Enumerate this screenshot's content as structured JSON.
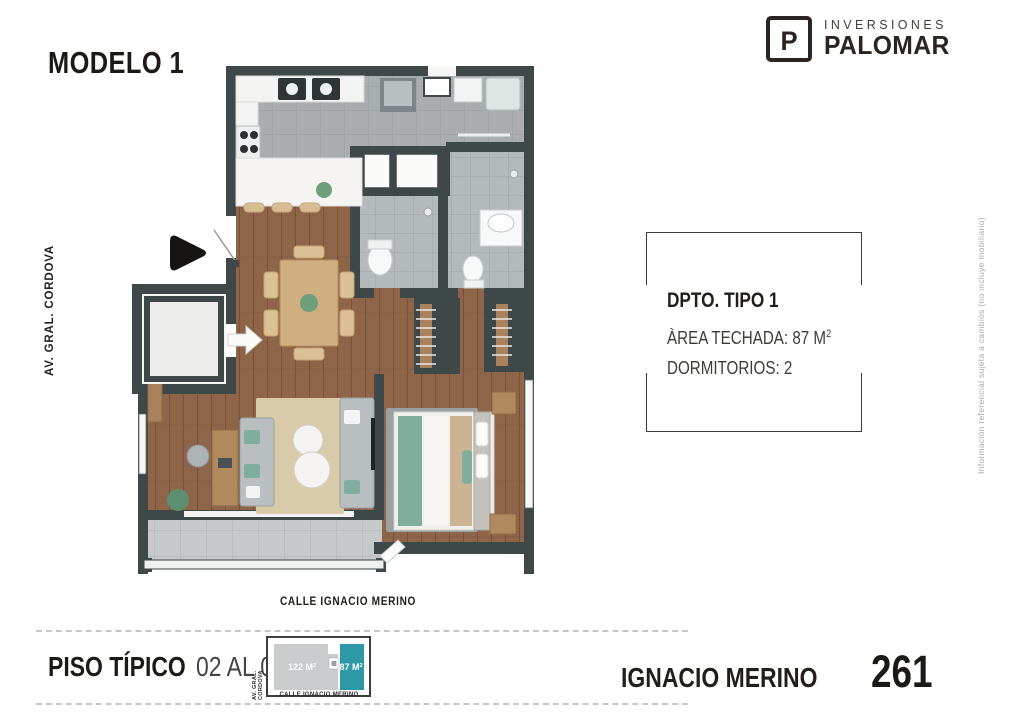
{
  "page": {
    "title": "MODELO 1",
    "street_left": "AV. GRAL. CORDOVA",
    "street_bottom": "CALLE IGNACIO MERINO",
    "side_note": "Información referencial sujeta a cambios (no incluye mobiliario)"
  },
  "logo": {
    "monogram": "P",
    "brand_top": "INVERSIONES",
    "brand_bottom": "PALOMAR"
  },
  "info_box": {
    "title": "DPTO. TIPO 1",
    "area_line": "ÀREA TECHADA: 87 M",
    "area_sup": "2",
    "bedrooms_line": "DORMITORIOS: 2"
  },
  "footer": {
    "floor_bold": "PISO TÍPICO",
    "floor_range": "02 AL 08",
    "keyplan": {
      "street_left": "AV. GRAL. CORDOVA",
      "street_bottom": "CALLE IGNACIO MERINO",
      "area_other": "122 M",
      "area_other_sup": "2",
      "area_highlight": "87 M",
      "area_highlight_sup": "2"
    },
    "project_name": "IGNACIO MERINO",
    "project_number": "261"
  },
  "colors": {
    "accent_teal": "#2E99A6",
    "wall_dark": "#3E4848",
    "wood_floor": "#8F6549",
    "text_dark": "#1D1916",
    "muted_note": "#A8A8A8"
  }
}
